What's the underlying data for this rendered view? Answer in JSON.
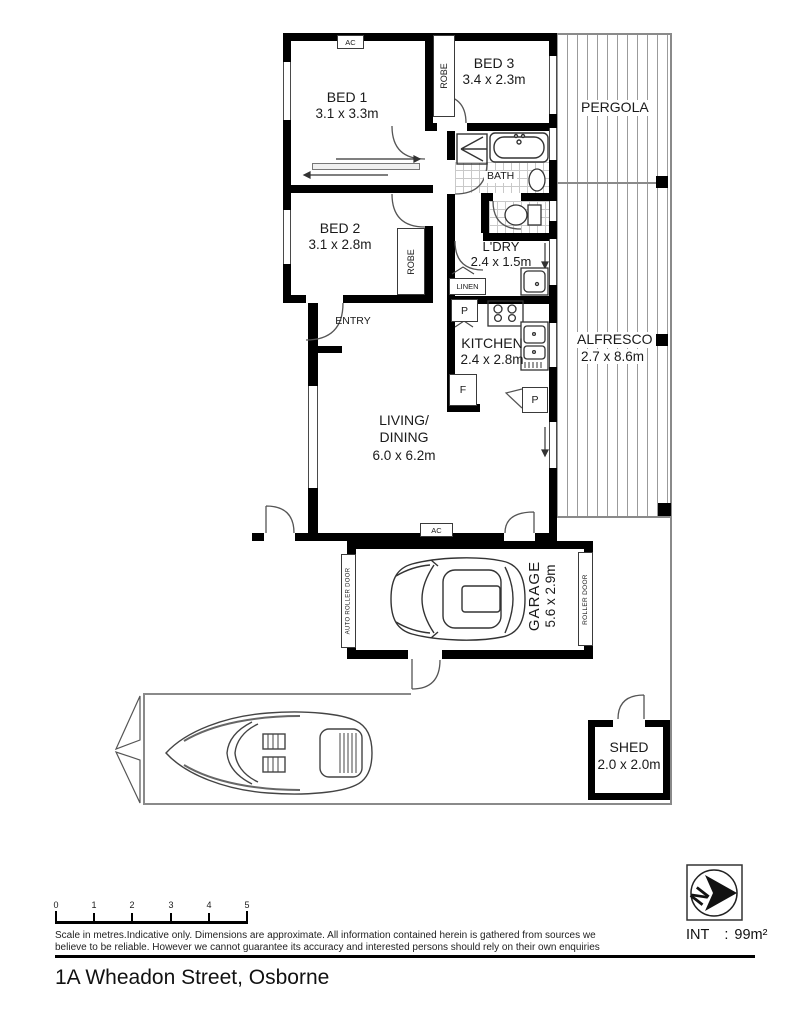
{
  "address": "1A Wheadon Street, Osborne",
  "interior_area": {
    "label": "INT",
    "colon": ":",
    "value": "99m²"
  },
  "compass": {
    "letter": "N"
  },
  "rooms": {
    "bed1": {
      "name": "BED 1",
      "dims": "3.1 x 3.3m"
    },
    "bed2": {
      "name": "BED 2",
      "dims": "3.1 x 2.8m"
    },
    "bed3": {
      "name": "BED 3",
      "dims": "3.4 x 2.3m"
    },
    "bath": {
      "name": "BATH"
    },
    "laundry": {
      "name": "L'DRY",
      "dims": "2.4 x 1.5m"
    },
    "kitchen": {
      "name": "KITCHEN",
      "dims": "2.4 x 2.8m"
    },
    "living": {
      "name_line1": "LIVING/",
      "name_line2": "DINING",
      "dims": "6.0 x 6.2m"
    },
    "entry": {
      "name": "ENTRY"
    },
    "garage": {
      "name": "GARAGE",
      "dims": "5.6 x 2.9m"
    },
    "pergola": {
      "name": "PERGOLA"
    },
    "alfresco": {
      "name": "ALFRESCO",
      "dims": "2.7 x 8.6m"
    },
    "shed": {
      "name": "SHED",
      "dims": "2.0 x 2.0m"
    }
  },
  "fixtures": {
    "robe": "ROBE",
    "linen": "LINEN",
    "pantry": "P",
    "fridge": "F",
    "ac": "AC",
    "auto_roller_door": "AUTO ROLLER DOOR",
    "roller_door": "ROLLER DOOR"
  },
  "scale_bar": {
    "ticks": [
      "0",
      "1",
      "2",
      "3",
      "4",
      "5"
    ],
    "disclaimer_line1": "Scale in metres.Indicative only. Dimensions are approximate. All information contained herein is gathered from sources we",
    "disclaimer_line2": "believe to be reliable. However we cannot guarantee its accuracy and interested persons should rely on their own enquiries"
  }
}
